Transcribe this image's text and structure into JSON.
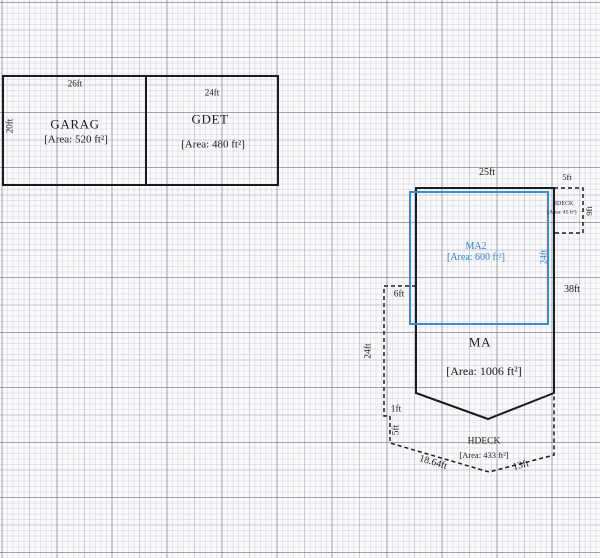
{
  "colors": {
    "line": "#1c1c1c",
    "accent": "#3a8cd8",
    "accent_text": "#2d7ecb",
    "grid_major": "#8a8c9c",
    "grid_minor": "#d9dae6",
    "background": "#fafafb"
  },
  "garage": {
    "title": "GARAG",
    "area": "[Area: 520 ft²]",
    "width_label": "26ft",
    "height_label": "20ft"
  },
  "gdet": {
    "title": "GDET",
    "area": "[Area: 480 ft²]",
    "width_label": "24ft"
  },
  "ma": {
    "title": "MA",
    "area": "[Area: 1006 ft²]",
    "top_label": "25ft",
    "right_label": "38ft"
  },
  "ma2": {
    "title": "MA2",
    "area": "[Area: 600 ft²]",
    "height_label": "24ft"
  },
  "hdeck_small": {
    "title": "HDECK",
    "area": "[Area: 45 ft²]",
    "top_label": "5ft",
    "right_label": "9ft"
  },
  "hdeck": {
    "title": "HDECK",
    "area": "[Area: 433 ft²]",
    "offset_label": "6ft",
    "left_label": "24ft",
    "jog_label": "1ft",
    "lower_left_label": "5ft",
    "diag_left_label": "18.64ft",
    "diag_right_label": "13ft"
  }
}
